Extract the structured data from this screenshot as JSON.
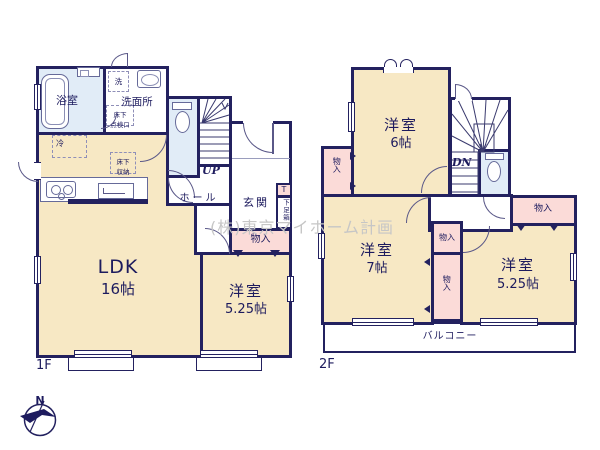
{
  "colors": {
    "wall": "#23215f",
    "room_fill": "#f7e8c4",
    "wet_fill": "#e1ecf7",
    "closet_fill": "#fbdbd8",
    "watermark": "#c6c6c6"
  },
  "watermark": "(株)東京マイホーム計画",
  "compass": {
    "north": "N"
  },
  "floor1": {
    "label": "1F",
    "ldk": {
      "name": "LDK",
      "size": "16帖"
    },
    "bedroom": {
      "name": "洋室",
      "size": "5.25帖"
    },
    "bath": {
      "name": "浴室"
    },
    "washroom": {
      "name": "洗面所"
    },
    "washer": {
      "name": "洗"
    },
    "underfloor_hatch": {
      "line1": "床下",
      "line2": "点検口"
    },
    "underfloor_storage": {
      "line1": "床下",
      "line2": "収納"
    },
    "fridge": {
      "name": "冷"
    },
    "hall": {
      "name": "ホール"
    },
    "entrance": {
      "name": "玄関"
    },
    "shoe_cabinet": {
      "tag": "T",
      "name": "下足箱"
    },
    "closet": {
      "name": "物入"
    },
    "stairs": {
      "direction": "UP"
    }
  },
  "floor2": {
    "label": "2F",
    "bedroom6": {
      "name": "洋室",
      "size": "6帖"
    },
    "bedroom7": {
      "name": "洋室",
      "size": "7帖"
    },
    "bedroom525": {
      "name": "洋室",
      "size": "5.25帖"
    },
    "closet_left": {
      "name": "物入"
    },
    "closet_mid_upper": {
      "name": "物入"
    },
    "closet_mid_lower": {
      "name": "物入"
    },
    "closet_right": {
      "name": "物入"
    },
    "balcony": {
      "name": "バルコニー"
    },
    "stairs": {
      "direction": "DN"
    }
  }
}
